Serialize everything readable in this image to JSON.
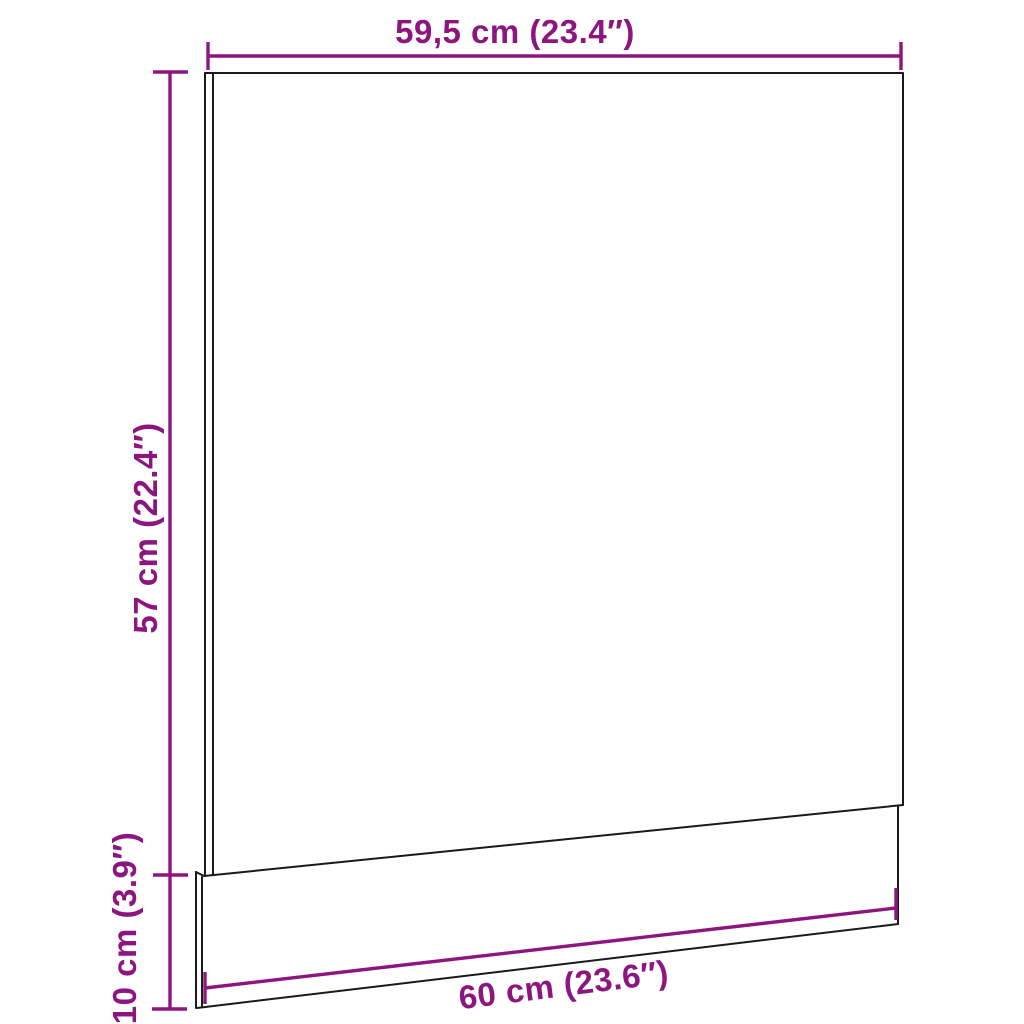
{
  "diagram": {
    "subject": "panel-with-plinth-dimension-diagram",
    "labels": {
      "width_top": "59,5 cm (23.4″)",
      "height_panel": "57 cm (22.4″)",
      "height_plinth": "10 cm (3.9″)",
      "width_bottom": "60 cm (23.6″)"
    },
    "colors": {
      "dimension_accent": "#8D157F",
      "outline": "#1A1A1A",
      "background": "#FFFFFF"
    }
  }
}
